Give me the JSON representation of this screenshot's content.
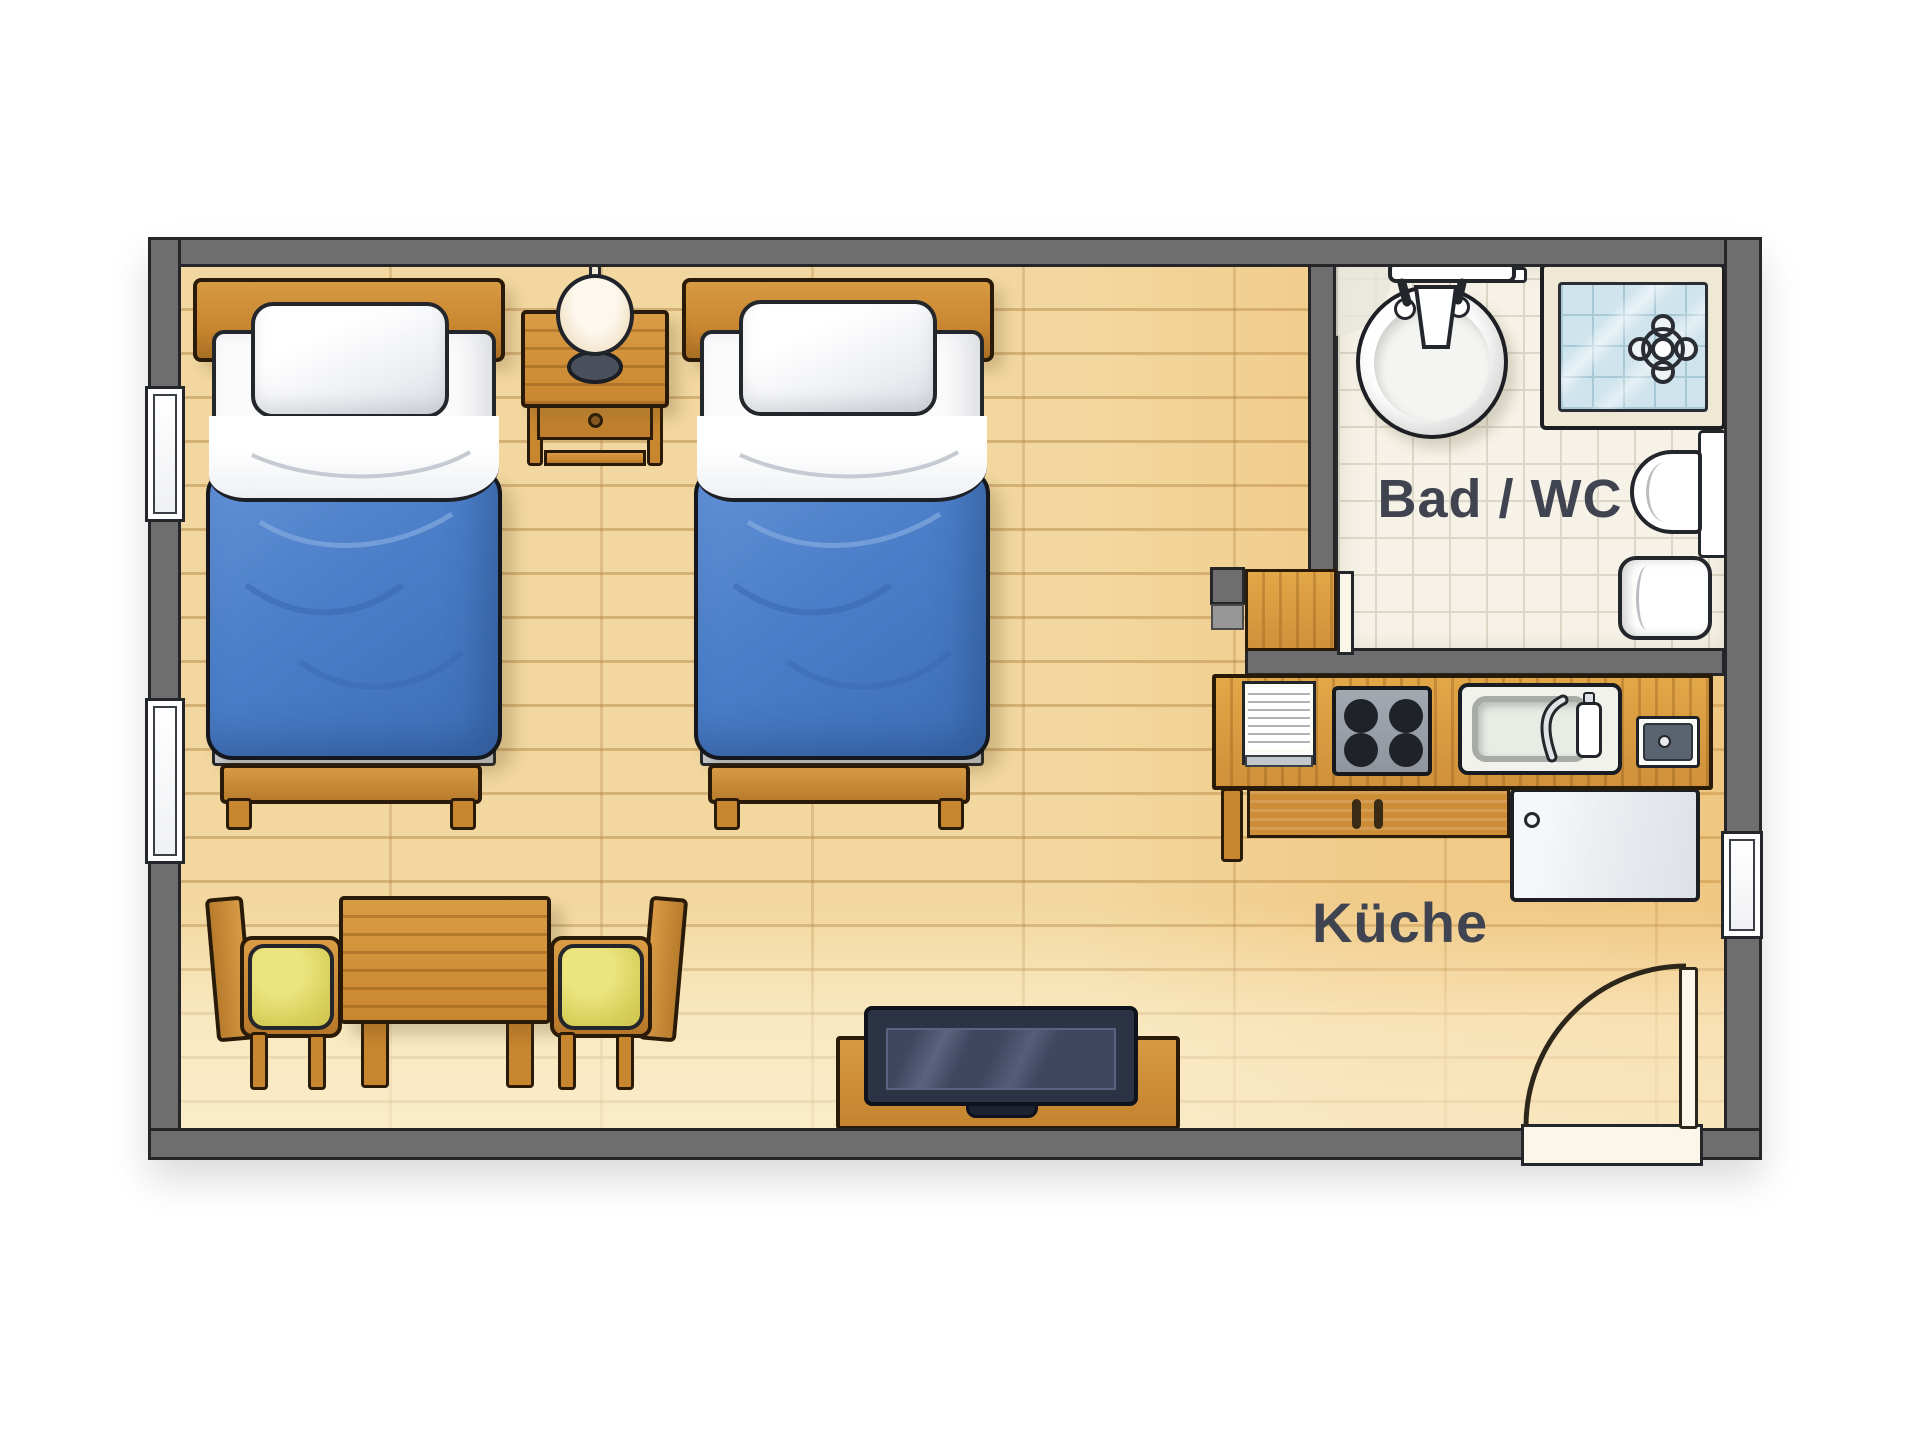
{
  "floorplan": {
    "labels": {
      "bathroom": "Bad / WC",
      "kitchen": "Küche"
    },
    "rooms": [
      "main-room",
      "bathroom",
      "kitchen-area"
    ],
    "furniture": [
      "bed",
      "bed",
      "nightstand",
      "table-lamp",
      "dining-table",
      "chair",
      "chair",
      "tv-lowboard",
      "tv",
      "kitchen-counter",
      "dish-rack",
      "stove",
      "kitchen-sink",
      "small-appliance",
      "fridge",
      "bathroom-sink",
      "shower",
      "toilet",
      "bidet",
      "entry-door",
      "bathroom-door",
      "window",
      "window",
      "window"
    ],
    "colors": {
      "wall": "#6e6e6e",
      "floor_wood": "#f2d8a0",
      "bath_tile": "#f6f2e7",
      "blanket_blue": "#4a7ec8",
      "furniture_wood": "#c8862f",
      "chair_cushion": "#d9d05c",
      "label_text": "#3f4450",
      "shower_glass": "#cfe4ec",
      "tv_screen": "#3e4660"
    }
  }
}
